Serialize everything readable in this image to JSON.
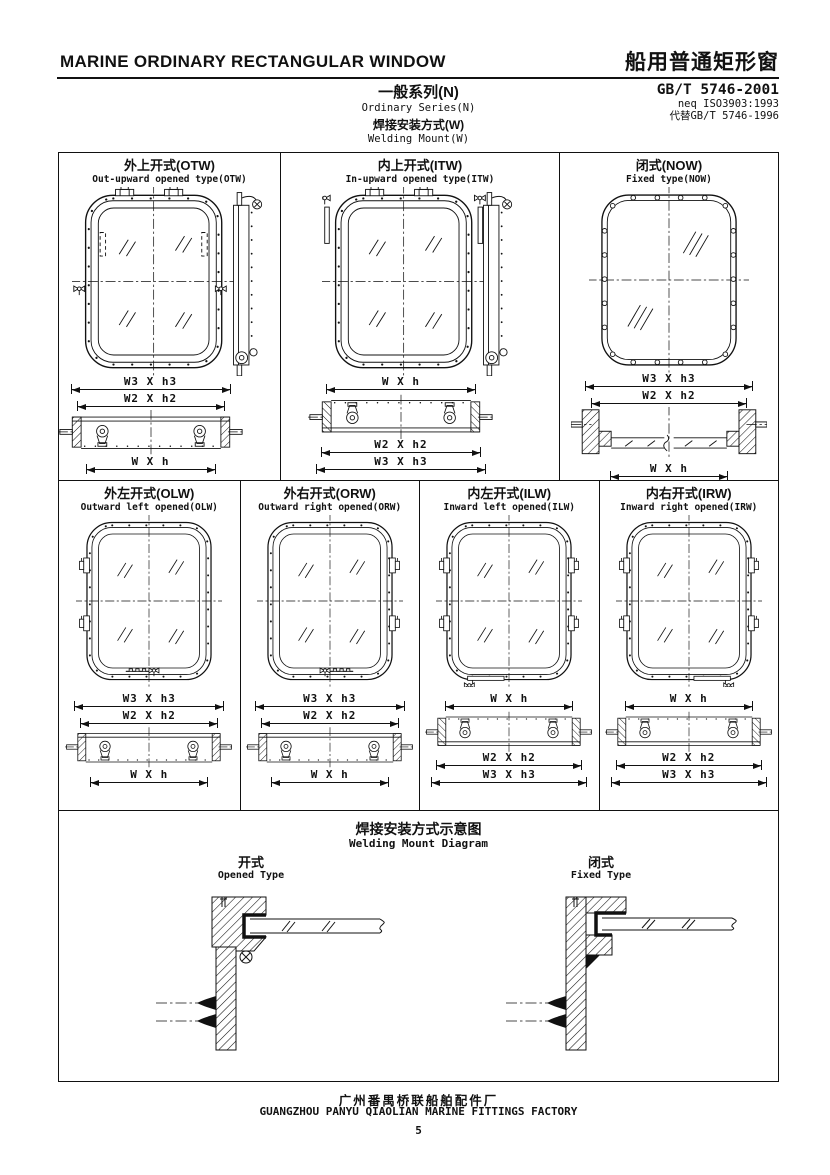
{
  "header": {
    "title_en": "MARINE ORDINARY RECTANGULAR WINDOW",
    "title_cn": "船用普通矩形窗",
    "standard": "GB/T 5746-2001",
    "standard_equiv": "neq ISO3903:1993",
    "standard_replaces": "代替GB/T 5746-1996",
    "series_cn": "一般系列(N)",
    "series_en": "Ordinary Series(N)",
    "mount_cn": "焊接安装方式(W)",
    "mount_en": "Welding Mount(W)"
  },
  "windows": {
    "otw": {
      "title_cn": "外上开式(OTW)",
      "title_en": "Out-upward opened type(OTW)",
      "dim_w3": "W3 X h3",
      "dim_w2": "W2 X h2",
      "dim_w": "W X h"
    },
    "itw": {
      "title_cn": "内上开式(ITW)",
      "title_en": "In-upward opened type(ITW)",
      "dim_w": "W X h",
      "dim_w2": "W2 X h2",
      "dim_w3": "W3 X h3"
    },
    "now": {
      "title_cn": "闭式(NOW)",
      "title_en": "Fixed type(NOW)",
      "dim_w3": "W3 X h3",
      "dim_w2": "W2 X h2",
      "dim_w": "W X h"
    },
    "olw": {
      "title_cn": "外左开式(OLW)",
      "title_en": "Outward left opened(OLW)",
      "dim_w3": "W3 X h3",
      "dim_w2": "W2 X h2",
      "dim_w": "W X h"
    },
    "orw": {
      "title_cn": "外右开式(ORW)",
      "title_en": "Outward right opened(ORW)",
      "dim_w3": "W3 X h3",
      "dim_w2": "W2 X h2",
      "dim_w": "W X h"
    },
    "ilw": {
      "title_cn": "内左开式(ILW)",
      "title_en": "Inward left opened(ILW)",
      "dim_w": "W X h",
      "dim_w2": "W2 X h2",
      "dim_w3": "W3 X h3"
    },
    "irw": {
      "title_cn": "内右开式(IRW)",
      "title_en": "Inward right opened(IRW)",
      "dim_w": "W X h",
      "dim_w2": "W2 X h2",
      "dim_w3": "W3 X h3"
    }
  },
  "welding_diagram": {
    "title_cn": "焊接安装方式示意图",
    "title_en": "Welding Mount Diagram",
    "opened_label_cn": "开式",
    "opened_label_en": "Opened Type",
    "fixed_label_cn": "闭式",
    "fixed_label_en": "Fixed Type"
  },
  "footer": {
    "factory_cn": "广州番禺桥联船舶配件厂",
    "factory_en": "GUANGZHOU PANYU QIAOLIAN MARINE FITTINGS FACTORY",
    "page_number": "5"
  },
  "colors": {
    "ink": "#111111",
    "paper": "#ffffff"
  }
}
